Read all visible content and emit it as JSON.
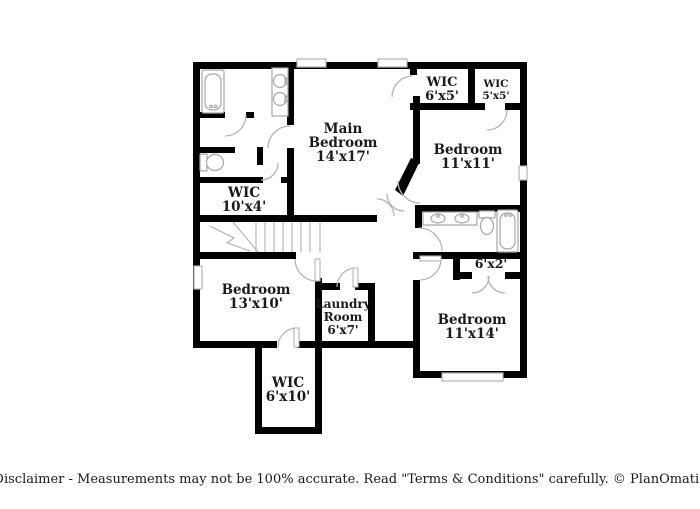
{
  "colors": {
    "background": "#ffffff",
    "walls": "#000000",
    "doors_windows": "#b4b4b4",
    "fixtures": "#a6a6a6",
    "text": "#1a1a1a"
  },
  "rooms": [
    {
      "name": "Main Bedroom",
      "dims": "14'x17'",
      "lines": [
        "Main",
        "Bedroom",
        "14'x17'"
      ]
    },
    {
      "name": "WIC",
      "dims": "6'x5'",
      "lines": [
        "WIC",
        "6'x5'"
      ]
    },
    {
      "name": "WIC",
      "dims": "5'x5'",
      "lines": [
        "WIC",
        "5'x5'"
      ]
    },
    {
      "name": "Bedroom",
      "dims": "11'x11'",
      "lines": [
        "Bedroom",
        "11'x11'"
      ]
    },
    {
      "name": "WIC",
      "dims": "10'x4'",
      "lines": [
        "WIC",
        "10'x4'"
      ]
    },
    {
      "name": "Bedroom",
      "dims": "13'x10'",
      "lines": [
        "Bedroom",
        "13'x10'"
      ]
    },
    {
      "name": "Laundry Room",
      "dims": "6'x7'",
      "lines": [
        "Laundry",
        "Room",
        "6'x7'"
      ]
    },
    {
      "name": "Closet",
      "dims": "6'x2'",
      "lines": [
        "6'x2'"
      ]
    },
    {
      "name": "Bedroom",
      "dims": "11'x14'",
      "lines": [
        "Bedroom",
        "11'x14'"
      ]
    },
    {
      "name": "WIC",
      "dims": "6'x10'",
      "lines": [
        "WIC",
        "6'x10'"
      ]
    }
  ],
  "fixtures": [
    "bathtub",
    "vanity-double-sink",
    "toilet",
    "stairs",
    "doors",
    "windows"
  ],
  "footer": {
    "disclaimer": "Disclaimer - Measurements may not be 100% accurate. Read \"Terms & Conditions\" carefully. © PlanOmatic"
  }
}
